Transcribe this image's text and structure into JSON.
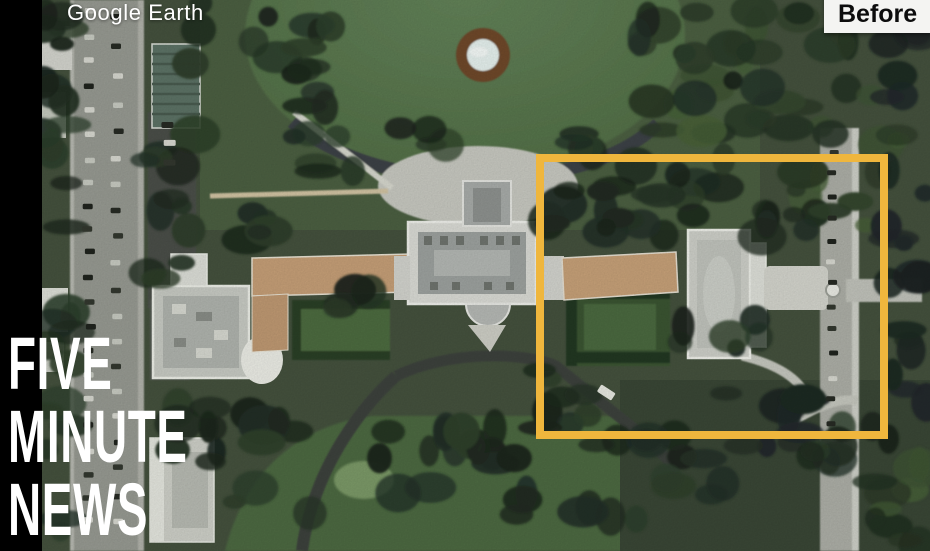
{
  "frame": {
    "watermark": "Google Earth",
    "badge": "Before",
    "brand": {
      "line1": "FIVE",
      "line2": "MINUTE",
      "line3": "NEWS"
    }
  },
  "map": {
    "type": "satellite-aerial",
    "scene": "Aerial satellite view of the White House complex with East Wing area highlighted",
    "highlight_color": "#EFB63D"
  },
  "colors": {
    "letterbox": "#000000",
    "badge_bg": "#F4F4F2",
    "badge_text": "#0D0D0D",
    "watermark_text": "#FFFFFF",
    "brand_text": "#FFFFFF"
  }
}
